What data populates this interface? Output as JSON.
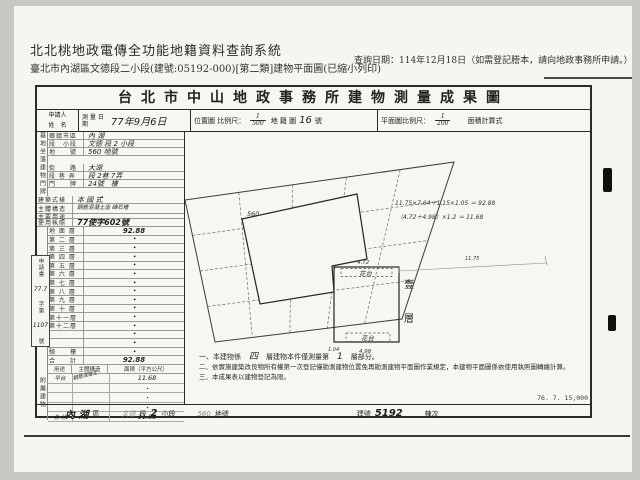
{
  "header": {
    "system_title": "北北桃地政電傳全功能地籍資料查詢系統",
    "subtitle": "臺北市內湖區文德段二小段(建號:05192-000)[第二類]建物平面圖(已縮小列印)",
    "query_date": "查詢日期：114年12月18日（如需登記謄本，請向地政事務所申請。）"
  },
  "doc": {
    "title": "台北市中山地政事務所建物測量成果圖",
    "info": {
      "applicant": "申請人",
      "name": "姓　名",
      "survey_date": "測 量 日 期",
      "survey_date_value": "77年9月6日",
      "loc_scale": "位置圖 比例尺：",
      "loc_num": "1",
      "loc_den": "500",
      "cad_map": "地 籍 圖",
      "cad_sheet": "16",
      "cad_unit": "號",
      "plan_scale": "平面圖比例尺：",
      "plan_num": "1",
      "plan_den": "200",
      "area_calc": "面積計算式"
    },
    "site_group": "基地坐落",
    "site_rows": [
      {
        "label": "鄉鎮市區",
        "value": "內 湖"
      },
      {
        "label": "段　小段",
        "value": "文德 段 2 小段"
      },
      {
        "label": "地　　號",
        "value": "560 地號"
      }
    ],
    "door_group": "建物門牌",
    "door_rows": [
      {
        "label": "街　　路",
        "value": "大湖"
      },
      {
        "label": "段 巷 弄",
        "value": "段 2巷 7弄"
      },
      {
        "label": "門　　牌",
        "value": "24號　樓"
      }
    ],
    "attr_style_label": "建築式樣",
    "attr_style_value": "本 國 式",
    "attr_struct_label": "主體構造",
    "attr_struct_value": "鋼筋混凝土造 磚石墻",
    "attr_use_label": "主要用途",
    "attr_use_value": "",
    "attr_lic_label": "使用執照",
    "attr_lic_value": "77使字602號",
    "area_group": "建物面積（平方公尺）",
    "floors": [
      {
        "label": "地 面 層",
        "value": "92.88"
      },
      {
        "label": "第 二 層",
        "value": "・"
      },
      {
        "label": "第 三 層",
        "value": "・"
      },
      {
        "label": "第 四 層",
        "value": "・"
      },
      {
        "label": "第 五 層",
        "value": "・"
      },
      {
        "label": "第 六 層",
        "value": "・"
      },
      {
        "label": "第 七 層",
        "value": "・"
      },
      {
        "label": "第 八 層",
        "value": "・"
      },
      {
        "label": "第 九 層",
        "value": "・"
      },
      {
        "label": "第 十 層",
        "value": "・"
      },
      {
        "label": "第十一層",
        "value": "・"
      },
      {
        "label": "第十二層",
        "value": "・"
      },
      {
        "label": "",
        "value": "・"
      },
      {
        "label": "",
        "value": "・"
      },
      {
        "label": "騎　　樓",
        "value": "・"
      },
      {
        "label": "合　　計",
        "value": "92.88"
      }
    ],
    "application": {
      "l1": "申請書",
      "hw1": "77.7",
      "l2": "字第",
      "hw2": "1107",
      "l3": "號"
    },
    "attached_group": "附屬建物",
    "attached_header": {
      "use": "用途",
      "structure": "主體構造",
      "area": "面積（平方公尺）"
    },
    "attached_rows": [
      {
        "use": "平台",
        "structure": "鋼筋混凝土",
        "area": "11.68"
      },
      {
        "use": "",
        "structure": "",
        "area": "・"
      },
      {
        "use": "",
        "structure": "",
        "area": "・"
      },
      {
        "use": "",
        "structure": "",
        "area": "・"
      },
      {
        "use": "合 計",
        "structure": "",
        "area": "11.68"
      }
    ],
    "drawing": {
      "lot_label": "560",
      "formula1": "11.75×7.64＋1.15×1.05 ＝ 92.88",
      "formula2": "（4.72＋4.98）×1.2 ＝ 11.68",
      "dim_top": "4.72",
      "dim_bottom": "4.98",
      "dim_right": "11.75",
      "dim_left": "1.04",
      "flower_top": "花台",
      "flower_bottom": "花台",
      "floor_char1": "壹",
      "floor_char2": "層"
    },
    "notes": {
      "n1a": "一、本建物係",
      "n1hw1": "四",
      "n1b": "層建物本件僅測量第",
      "n1hw2": "1",
      "n1c": "層部分。",
      "n2": "二、依實施建築改良物所有權第一次登記僅勘測建物位置免再勘測建物平面圖作業規定，本建物平面圖係依使用執照圖轉繪計算。",
      "n3": "三、本成果表以建物登記為限。"
    },
    "footer": {
      "district_hw": "內 湖",
      "district": "區",
      "section_hw": "文德",
      "section": "段",
      "subsection_hw": "2",
      "subsection": "小段",
      "lot_hw": "560",
      "lot": "地號",
      "bno": "建號",
      "bno_hw": "5192",
      "unit": "棟次",
      "print_code": "76. 7. 15,000"
    }
  }
}
